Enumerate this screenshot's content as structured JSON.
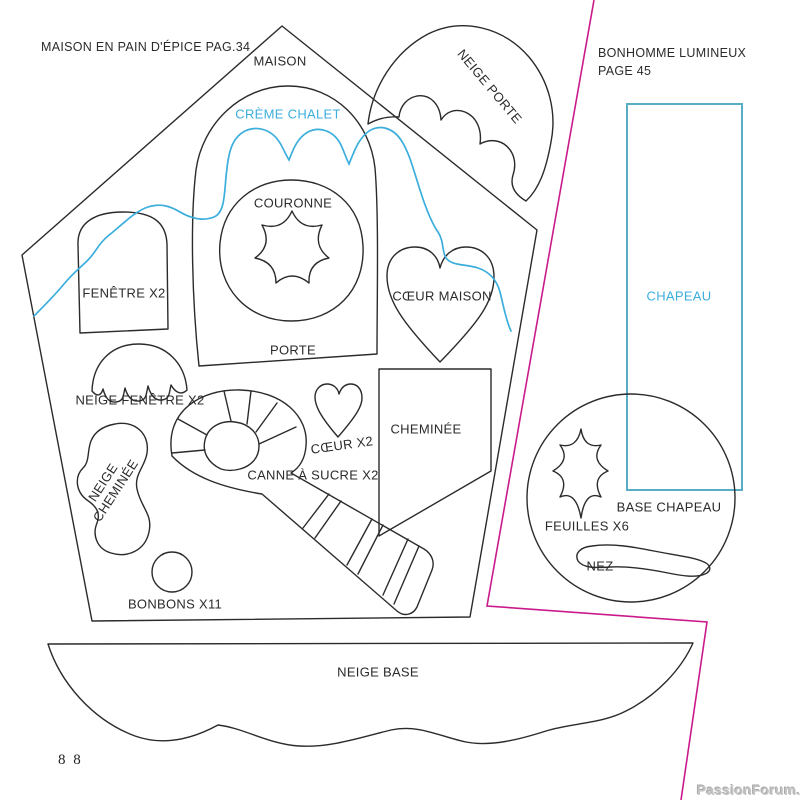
{
  "colors": {
    "outline": "#2b2b2b",
    "cyan": "#3BAEDC",
    "cyan_rect": "#57ADC4",
    "magenta": "#CB1A8C"
  },
  "left_section": {
    "title": "MAISON EN PAIN D'ÉPICE PAG.34",
    "labels": {
      "maison": "MAISON",
      "creme_chalet": "CRÈME CHALET",
      "couronne": "COURONNE",
      "fenetre": "FENÊTRE X2",
      "coeur_maison": "CŒUR MAISON",
      "porte": "PORTE",
      "neige_fenetre": "NEIGE FENÊTRE X2",
      "neige_cheminee_line1": "NEIGE",
      "neige_cheminee_line2": "CHEMINÉE",
      "coeur": "CŒUR X2",
      "cheminee": "CHEMINÉE",
      "canne_a_sucre": "CANNE À SUCRE X2",
      "bonbons": "BONBONS X11",
      "neige_base": "NEIGE BASE",
      "neige_porte": "NEIGE PORTE"
    }
  },
  "right_section": {
    "title_line1": "BONHOMME LUMINEUX",
    "title_line2": "PAGE 45",
    "labels": {
      "chapeau": "CHAPEAU",
      "base_chapeau": "BASE CHAPEAU",
      "feuilles": "FEUILLES X6",
      "nez": "NEZ"
    }
  },
  "footer": {
    "page_number": "8 8",
    "watermark": "PassionForum.ru"
  }
}
